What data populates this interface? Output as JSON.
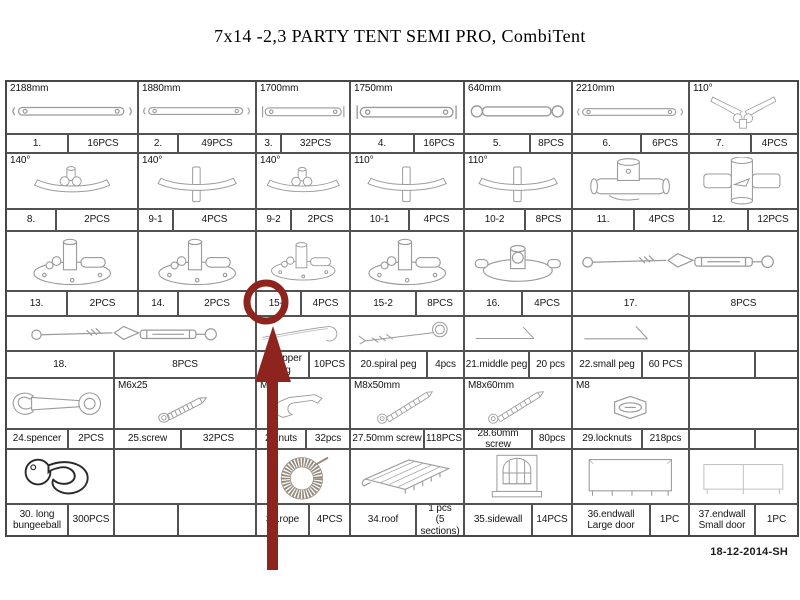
{
  "title": "7x14 -2,3 PARTY TENT SEMI PRO, CombiTent",
  "date_code": "18-12-2014-SH",
  "annotation": {
    "circled_label": "15-1",
    "color": "#8e241e"
  },
  "table": {
    "rows": [
      {
        "type": "images",
        "h": 53,
        "cells": [
          {
            "icon": "pole-long",
            "label": "2188mm",
            "w": 132
          },
          {
            "icon": "pole-long",
            "label": "1880mm",
            "w": 118
          },
          {
            "icon": "pole-bracket",
            "label": "1700mm",
            "w": 94
          },
          {
            "icon": "pole-bracket",
            "label": "1750mm",
            "w": 114
          },
          {
            "icon": "pole-short",
            "label": "640mm",
            "w": 108
          },
          {
            "icon": "pole-long",
            "label": "2210mm",
            "w": 117
          },
          {
            "icon": "corner-3way",
            "label": "110°",
            "w": 107
          }
        ]
      },
      {
        "type": "labels",
        "h": 19,
        "cells": [
          {
            "t": "1.",
            "w": 62
          },
          {
            "t": "16PCS",
            "w": 70
          },
          {
            "t": "2.",
            "w": 40
          },
          {
            "t": "49PCS",
            "w": 78
          },
          {
            "t": "3.",
            "w": 25
          },
          {
            "t": "32PCS",
            "w": 69
          },
          {
            "t": "4.",
            "w": 64
          },
          {
            "t": "16PCS",
            "w": 50
          },
          {
            "t": "5.",
            "w": 66
          },
          {
            "t": "8PCS",
            "w": 42
          },
          {
            "t": "6.",
            "w": 69
          },
          {
            "t": "6PCS",
            "w": 48
          },
          {
            "t": "7.",
            "w": 62
          },
          {
            "t": "4PCS",
            "w": 45
          }
        ]
      },
      {
        "type": "images",
        "h": 56,
        "cells": [
          {
            "icon": "bracket-clamp",
            "label": "140°",
            "w": 132
          },
          {
            "icon": "bracket-plain",
            "label": "140°",
            "w": 118
          },
          {
            "icon": "bracket-clamp",
            "label": "140°",
            "w": 94
          },
          {
            "icon": "bracket-plain",
            "label": "110°",
            "w": 114
          },
          {
            "icon": "bracket-plain",
            "label": "110°",
            "w": 108
          },
          {
            "icon": "tee-connector",
            "w": 117
          },
          {
            "icon": "cross-connector",
            "w": 107
          }
        ]
      },
      {
        "type": "labels",
        "h": 22,
        "cells": [
          {
            "t": "8.",
            "w": 50
          },
          {
            "t": "2PCS",
            "w": 82
          },
          {
            "t": "9-1",
            "w": 35
          },
          {
            "t": "4PCS",
            "w": 83
          },
          {
            "t": "9-2",
            "w": 35
          },
          {
            "t": "2PCS",
            "w": 59
          },
          {
            "t": "10-1",
            "w": 59
          },
          {
            "t": "4PCS",
            "w": 55
          },
          {
            "t": "10-2",
            "w": 61
          },
          {
            "t": "8PCS",
            "w": 47
          },
          {
            "t": "11.",
            "w": 62
          },
          {
            "t": "4PCS",
            "w": 55
          },
          {
            "t": "12.",
            "w": 59
          },
          {
            "t": "12PCS",
            "w": 48
          }
        ]
      },
      {
        "type": "images",
        "h": 60,
        "cells": [
          {
            "icon": "foot-plate",
            "w": 132
          },
          {
            "icon": "foot-plate",
            "w": 118
          },
          {
            "icon": "foot-plate",
            "w": 94
          },
          {
            "icon": "foot-plate",
            "w": 114
          },
          {
            "icon": "foot-plate-small",
            "w": 108
          },
          {
            "icon": "turnbuckle",
            "w": 224
          }
        ]
      },
      {
        "type": "labels",
        "h": 25,
        "cells": [
          {
            "t": "13.",
            "w": 61
          },
          {
            "t": "2PCS",
            "w": 71
          },
          {
            "t": "14.",
            "w": 40
          },
          {
            "t": "2PCS",
            "w": 78
          },
          {
            "t": "15-1",
            "w": 45
          },
          {
            "t": "4PCS",
            "w": 49
          },
          {
            "t": "15-2",
            "w": 66
          },
          {
            "t": "8PCS",
            "w": 48
          },
          {
            "t": "16.",
            "w": 58
          },
          {
            "t": "4PCS",
            "w": 50
          },
          {
            "t": "17.",
            "w": 117
          },
          {
            "t": "8PCS",
            "w": 107
          }
        ]
      },
      {
        "type": "images",
        "h": 35,
        "cells": [
          {
            "icon": "turnbuckle",
            "w": 250
          },
          {
            "icon": "hook-peg",
            "w": 94
          },
          {
            "icon": "spiral-peg",
            "w": 114
          },
          {
            "icon": "angle-peg",
            "w": 108
          },
          {
            "icon": "angle-peg",
            "w": 117
          },
          {
            "w": 107
          }
        ]
      },
      {
        "type": "labels",
        "h": 27,
        "cells": [
          {
            "t": "18.",
            "w": 108
          },
          {
            "t": "8PCS",
            "w": 142
          },
          {
            "t": "19.upper peg",
            "w": 53
          },
          {
            "t": "10PCS",
            "w": 41
          },
          {
            "t": "20.spiral peg",
            "w": 77
          },
          {
            "t": "4pcs",
            "w": 37
          },
          {
            "t": "21.middle peg",
            "w": 65
          },
          {
            "t": "20 pcs",
            "w": 43
          },
          {
            "t": "22.small peg",
            "w": 70
          },
          {
            "t": "60 PCS",
            "w": 47
          },
          {
            "t": "",
            "w": 66
          },
          {
            "t": "",
            "w": 41
          }
        ]
      },
      {
        "type": "images",
        "h": 51,
        "cells": [
          {
            "icon": "wrench",
            "w": 108
          },
          {
            "icon": "screw",
            "label": "M6x25",
            "w": 142
          },
          {
            "icon": "clip",
            "label": "M6",
            "w": 94
          },
          {
            "icon": "bolt",
            "label": "M8x50mm",
            "w": 114
          },
          {
            "icon": "bolt",
            "label": "M8x60mm",
            "w": 108
          },
          {
            "icon": "hex-nut",
            "label": "M8",
            "w": 117
          },
          {
            "w": 107
          }
        ]
      },
      {
        "type": "labels",
        "h": 20,
        "cells": [
          {
            "t": "24.spencer",
            "w": 62
          },
          {
            "t": "2PCS",
            "w": 46
          },
          {
            "t": "25.screw",
            "w": 67
          },
          {
            "t": "32PCS",
            "w": 75
          },
          {
            "t": "26.nuts",
            "w": 50
          },
          {
            "t": "32pcs",
            "w": 44
          },
          {
            "t": "27.50mm screw",
            "w": 74
          },
          {
            "t": "118PCS",
            "w": 40
          },
          {
            "t": "28.60mm screw",
            "w": 68
          },
          {
            "t": "80pcs",
            "w": 40
          },
          {
            "t": "29.locknuts",
            "w": 70
          },
          {
            "t": "218pcs",
            "w": 47
          },
          {
            "t": "",
            "w": 66
          },
          {
            "t": "",
            "w": 41
          }
        ]
      },
      {
        "type": "images",
        "h": 55,
        "cells": [
          {
            "icon": "bungee-ball",
            "w": 108
          },
          {
            "w": 142
          },
          {
            "icon": "rope-coil",
            "w": 94
          },
          {
            "icon": "roof-bundle",
            "w": 114
          },
          {
            "icon": "sidewall",
            "w": 108
          },
          {
            "icon": "endwall-large",
            "w": 117
          },
          {
            "icon": "endwall-small",
            "w": 107
          }
        ]
      },
      {
        "type": "labels",
        "h": 30,
        "cells": [
          {
            "t": "30. long\nbungeeball",
            "w": 62
          },
          {
            "t": "300PCS",
            "w": 46
          },
          {
            "t": "",
            "w": 64
          },
          {
            "t": "",
            "w": 78
          },
          {
            "t": "32.rope",
            "w": 53
          },
          {
            "t": "4PCS",
            "w": 41
          },
          {
            "t": "34.roof",
            "w": 66
          },
          {
            "t": "1 pcs\n(5 sections)",
            "w": 48
          },
          {
            "t": "35.sidewall",
            "w": 68
          },
          {
            "t": "14PCS",
            "w": 40
          },
          {
            "t": "36.endwall\nLarge door",
            "w": 78
          },
          {
            "t": "1PC",
            "w": 39
          },
          {
            "t": "37.endwall\nSmall door",
            "w": 66
          },
          {
            "t": "1PC",
            "w": 41
          }
        ]
      }
    ]
  }
}
